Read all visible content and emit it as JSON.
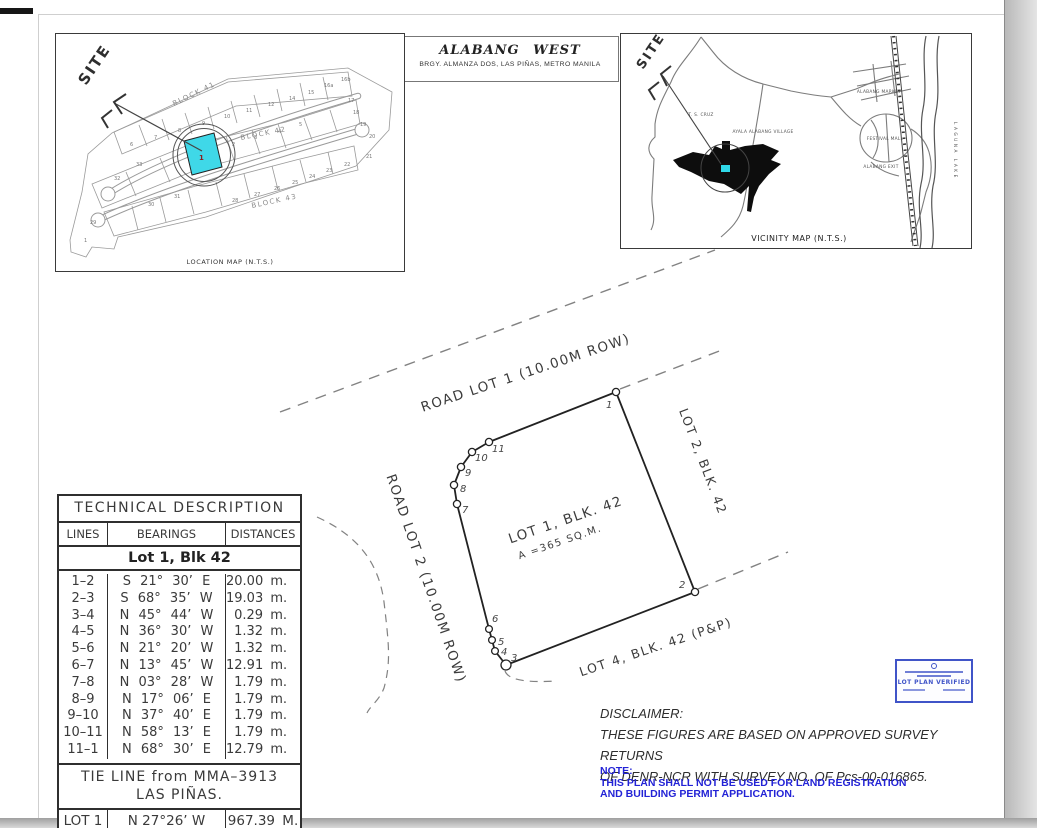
{
  "title_block": {
    "title": "ALABANG WEST",
    "subtitle": "BRGY. ALMANZA DOS, LAS PIÑAS, METRO MANILA"
  },
  "location_map": {
    "caption": "LOCATION MAP (N.T.S.)",
    "site_label": "SITE",
    "block_labels": [
      "BLOCK 41",
      "BLOCK 42",
      "BLOCK 43"
    ],
    "highlight_color": "#3fd8e8",
    "highlight_lot": "1",
    "lot_numbers": [
      {
        "n": "6",
        "x": 74,
        "y": 112
      },
      {
        "n": "7",
        "x": 98,
        "y": 105
      },
      {
        "n": "8",
        "x": 122,
        "y": 98
      },
      {
        "n": "9",
        "x": 146,
        "y": 91
      },
      {
        "n": "10",
        "x": 168,
        "y": 84
      },
      {
        "n": "11",
        "x": 190,
        "y": 78
      },
      {
        "n": "12",
        "x": 212,
        "y": 72
      },
      {
        "n": "14",
        "x": 233,
        "y": 66
      },
      {
        "n": "15",
        "x": 252,
        "y": 60
      },
      {
        "n": "16a",
        "x": 268,
        "y": 53
      },
      {
        "n": "16b",
        "x": 285,
        "y": 47
      },
      {
        "n": "17",
        "x": 292,
        "y": 68
      },
      {
        "n": "18",
        "x": 297,
        "y": 80
      },
      {
        "n": "19",
        "x": 304,
        "y": 92
      },
      {
        "n": "20",
        "x": 313,
        "y": 104
      },
      {
        "n": "21",
        "x": 310,
        "y": 124
      },
      {
        "n": "2",
        "x": 176,
        "y": 112
      },
      {
        "n": "3",
        "x": 198,
        "y": 105
      },
      {
        "n": "4",
        "x": 222,
        "y": 99
      },
      {
        "n": "5",
        "x": 243,
        "y": 92
      },
      {
        "n": "22",
        "x": 288,
        "y": 132
      },
      {
        "n": "23",
        "x": 270,
        "y": 138
      },
      {
        "n": "24",
        "x": 253,
        "y": 144
      },
      {
        "n": "25",
        "x": 236,
        "y": 150
      },
      {
        "n": "26",
        "x": 218,
        "y": 156
      },
      {
        "n": "27",
        "x": 198,
        "y": 162
      },
      {
        "n": "28",
        "x": 176,
        "y": 168
      },
      {
        "n": "31",
        "x": 118,
        "y": 164
      },
      {
        "n": "30",
        "x": 92,
        "y": 172
      },
      {
        "n": "33",
        "x": 80,
        "y": 132
      },
      {
        "n": "32",
        "x": 58,
        "y": 146
      },
      {
        "n": "29",
        "x": 34,
        "y": 190
      },
      {
        "n": "1",
        "x": 28,
        "y": 208
      }
    ]
  },
  "vicinity_map": {
    "caption": "VICINITY MAP (N.T.S.)",
    "site_label": "SITE",
    "labels": [
      "T. S. CRUZ",
      "AYALA ALABANG VILLAGE",
      "ALABANG MARKET",
      "FESTIVAL MALL",
      "ALABANG EXIT",
      "LAGUNA LAKE"
    ]
  },
  "plan": {
    "road_lot_1": "ROAD LOT 1 (10.00M ROW)",
    "road_lot_2": "ROAD LOT 2 (10.00M ROW)",
    "lot1_label": "LOT 1, BLK. 42",
    "lot1_area": "A =365 SQ.M.",
    "lot2_label": "LOT 2, BLK. 42",
    "lot4_label": "LOT 4, BLK. 42 (P&P)",
    "corners": [
      "1",
      "2",
      "3",
      "4",
      "5",
      "6",
      "7",
      "8",
      "9",
      "10",
      "11"
    ]
  },
  "tech_table": {
    "title": "TECHNICAL DESCRIPTION",
    "columns": [
      "LINES",
      "BEARINGS",
      "DISTANCES"
    ],
    "subtitle": "Lot 1, Blk 42",
    "rows": [
      {
        "line": "1–2",
        "bearing": "S 21° 30’ E",
        "distance": "20.00 m."
      },
      {
        "line": "2–3",
        "bearing": "S 68° 35’ W",
        "distance": "19.03 m."
      },
      {
        "line": "3–4",
        "bearing": "N 45° 44’ W",
        "distance": "0.29 m."
      },
      {
        "line": "4–5",
        "bearing": "N 36° 30’ W",
        "distance": "1.32 m."
      },
      {
        "line": "5–6",
        "bearing": "N 21° 20’ W",
        "distance": "1.32 m."
      },
      {
        "line": "6–7",
        "bearing": "N 13° 45’ W",
        "distance": "12.91 m."
      },
      {
        "line": "7–8",
        "bearing": "N 03° 28’ W",
        "distance": "1.79 m."
      },
      {
        "line": "8–9",
        "bearing": "N 17° 06’ E",
        "distance": "1.79 m."
      },
      {
        "line": "9–10",
        "bearing": "N 37° 40’ E",
        "distance": "1.79 m."
      },
      {
        "line": "10–11",
        "bearing": "N 58° 13’ E",
        "distance": "1.79 m."
      },
      {
        "line": "11–1",
        "bearing": "N 68° 30’ E",
        "distance": "12.79 m."
      }
    ],
    "tie_line_1": "TIE LINE from MMA–3913",
    "tie_line_2": "LAS PIÑAS.",
    "tie_row": {
      "line": "LOT 1",
      "bearing": "N 27°26’ W",
      "distance": "967.39 M."
    }
  },
  "disclaimer": {
    "title": "DISCLAIMER:",
    "line1": "THESE FIGURES ARE BASED ON APPROVED SURVEY RETURNS",
    "line2": "OF DENR-NCR WITH SURVEY NO. OF Pcs-00-016865."
  },
  "note": {
    "title": "NOTE:",
    "line1": "THIS PLAN SHALL NOT BE USED FOR LAND REGISTRATION",
    "line2": "AND BUILDING PERMIT APPLICATION."
  },
  "stamp": {
    "text": "LOT PLAN VERIFIED"
  }
}
